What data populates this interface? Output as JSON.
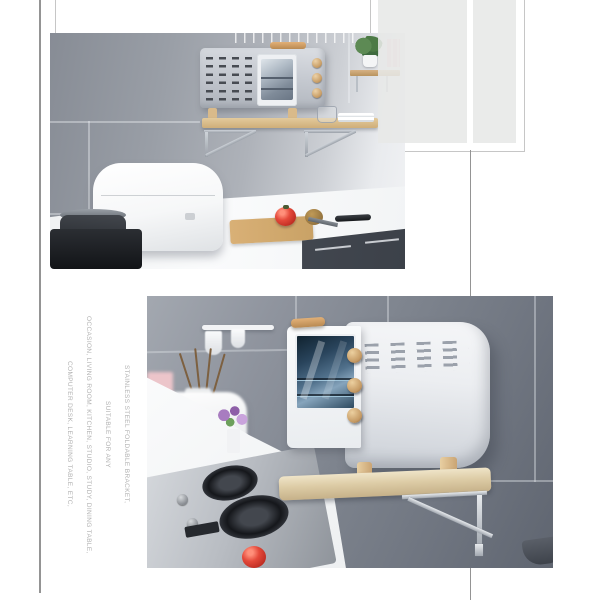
{
  "caption": {
    "lines": [
      "STAINLESS STEEL FOLDABLE BRACKET,",
      "SUITABLE FOR ANY",
      "OCCASION, LIVING ROOM, KITCHEN, STUDIO, STUDY, DINING TABLE,",
      "COMPUTER DESK, LEARNING TABLE, ETC,"
    ]
  },
  "colors": {
    "line-gray": "#949494",
    "frame-gray": "#c6c6c6",
    "block-gray": "#e7e8e7",
    "caption-gray": "#b2b2b2",
    "wood-light": "#e2b077",
    "wood-dark": "#b98a52",
    "tomato": "#b5261d",
    "tomato-light": "#ff8f7a",
    "pink": "#ecc5ca",
    "counter": "#f2f4f5",
    "drawer": "#3c4149",
    "steel-dark": "#26292e"
  }
}
